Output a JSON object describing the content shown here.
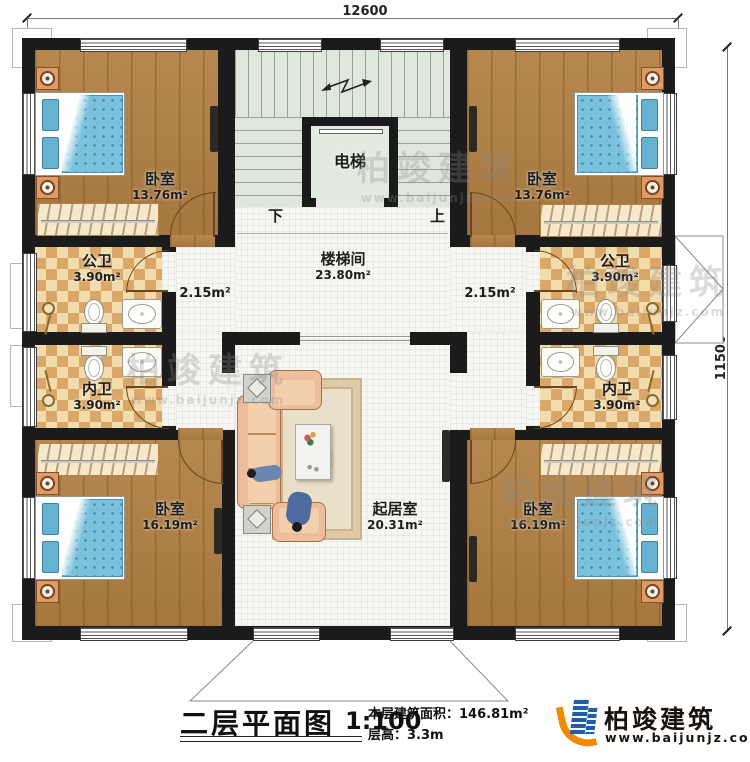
{
  "dimensions": {
    "top": "12600",
    "right": "11500"
  },
  "rooms": {
    "bedroom_tl": {
      "name": "卧室",
      "area": "13.76m²"
    },
    "bedroom_tr": {
      "name": "卧室",
      "area": "13.76m²"
    },
    "bedroom_bl": {
      "name": "卧室",
      "area": "16.19m²"
    },
    "bedroom_br": {
      "name": "卧室",
      "area": "16.19m²"
    },
    "bath_public_left": {
      "name": "公卫",
      "area": "3.90m²"
    },
    "bath_private_left": {
      "name": "内卫",
      "area": "3.90m²"
    },
    "bath_public_right": {
      "name": "公卫",
      "area": "3.90m²"
    },
    "bath_private_right": {
      "name": "内卫",
      "area": "3.90m²"
    },
    "stairwell": {
      "name": "楼梯间",
      "area": "23.80m²"
    },
    "living": {
      "name": "起居室",
      "area": "20.31m²"
    },
    "elevator": {
      "name": "电梯"
    },
    "corridor_left": {
      "area": "2.15m²"
    },
    "corridor_right": {
      "area": "2.15m²"
    }
  },
  "stairs": {
    "down": "下",
    "up": "上"
  },
  "title": {
    "name": "二层平面图",
    "scale": "1:100",
    "area_label": "本层建筑面积：",
    "area_value": "146.81m²",
    "floor_height_label": "层高：",
    "floor_height_value": "3.3m"
  },
  "brand": {
    "name": "柏竣建筑",
    "site": "www.baijunjz.com"
  },
  "watermark": {
    "name": "柏竣建筑",
    "site": "www.baijunjz.com"
  },
  "colors": {
    "wall": "#1b1b1b",
    "wood": "#b28044",
    "tile": "#d9a868",
    "stair": "#dfe7dc",
    "bed": "#79c1dc",
    "sofa": "#eebd9b",
    "brand_blue": "#1f5fa9",
    "brand_orange": "#f28a00"
  }
}
